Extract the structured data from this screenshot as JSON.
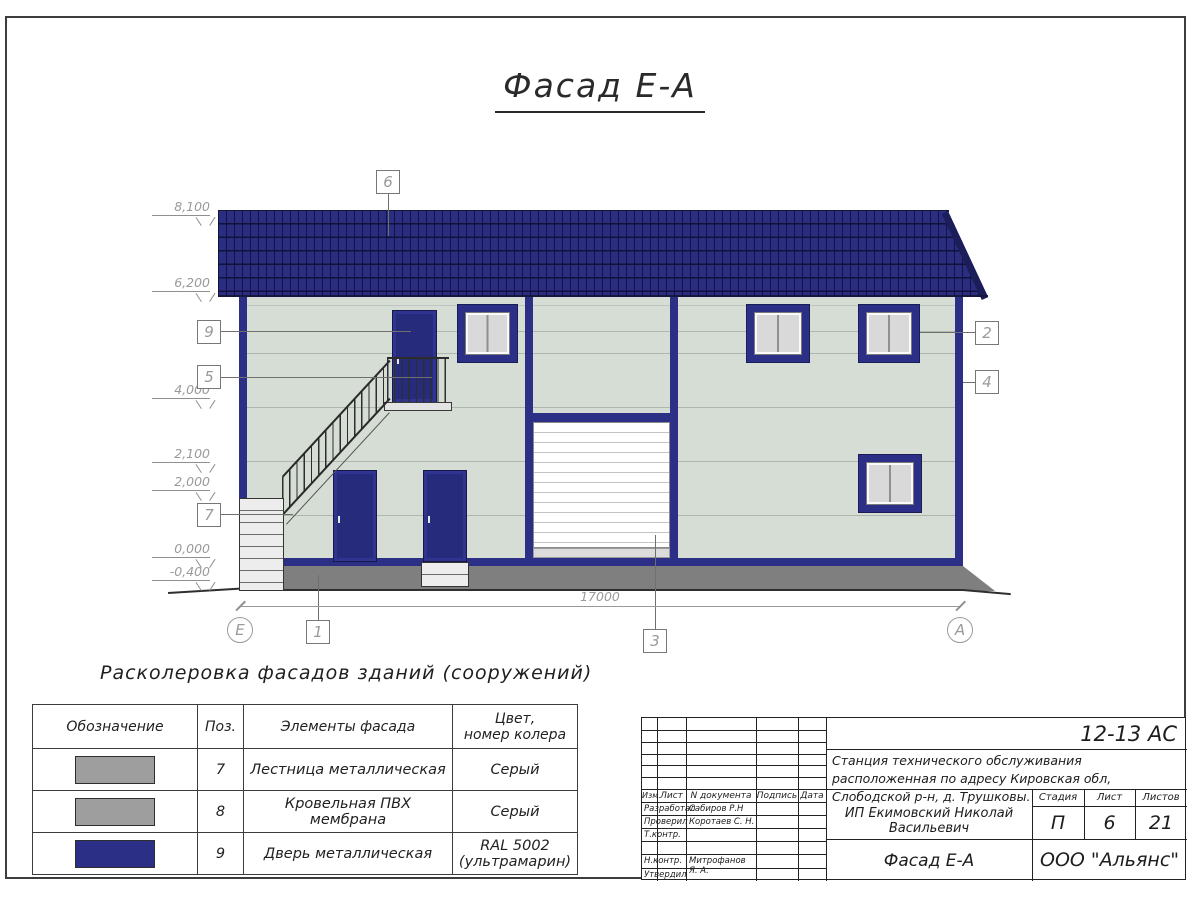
{
  "sheet": {
    "title": "Фасад Е-А"
  },
  "elevation_view": {
    "levels": [
      {
        "value": "8,100"
      },
      {
        "value": "6,200"
      },
      {
        "value": "4,000"
      },
      {
        "value": "2,100"
      },
      {
        "value": "2,000"
      },
      {
        "value": "0,000"
      },
      {
        "value": "-0,400"
      }
    ],
    "callouts": {
      "c1": "1",
      "c2": "2",
      "c3": "3",
      "c4": "4",
      "c5": "5",
      "c6": "6",
      "c7": "7",
      "c9": "9"
    },
    "axes": {
      "left": "Е",
      "right": "А"
    },
    "dimension_total": "17000",
    "colors": {
      "roof": "#2b2e80",
      "wall": "#d6ddd5",
      "trim": "#2b2f86",
      "plinth": "#7f7f7f",
      "door": "#262b7c",
      "glass": "#d9d9d9"
    }
  },
  "legend": {
    "title": "Расколеровка фасадов зданий (сооружений)",
    "headers": [
      "Обозначение",
      "Поз.",
      "Элементы фасада",
      "Цвет,\nномер колера"
    ],
    "rows": [
      {
        "swatch": "#9e9e9e",
        "pos": "7",
        "element": "Лестница металлическая",
        "color": "Серый"
      },
      {
        "swatch": "#9e9e9e",
        "pos": "8",
        "element": "Кровельная ПВХ мембрана",
        "color": "Серый"
      },
      {
        "swatch": "#2b2f86",
        "pos": "9",
        "element": "Дверь металлическая",
        "color": "RAL 5002\n(ультрамарин)"
      }
    ]
  },
  "title_block": {
    "doc_code": "12-13 АС",
    "object_description": "Станция технического обслуживания расположенная по адресу Кировская обл, Слободской р-н, д. Трушковы.",
    "client": "ИП Екимовский Николай Васильевич",
    "columns": {
      "izm": "Изм.",
      "list": "Лист",
      "doc": "N документа",
      "sign": "Подпись",
      "date": "Дата"
    },
    "roles": [
      {
        "role": "Разработал",
        "name": "Сабиров Р.Н"
      },
      {
        "role": "Проверил",
        "name": "Коротаев С. Н."
      },
      {
        "role": "Т.контр.",
        "name": ""
      },
      {
        "role": "",
        "name": ""
      },
      {
        "role": "Н.контр.",
        "name": "Митрофанов Я. А."
      },
      {
        "role": "Утвердил",
        "name": ""
      }
    ],
    "stage_headers": {
      "stage": "Стадия",
      "sheet": "Лист",
      "sheets": "Листов"
    },
    "stage_values": {
      "stage": "П",
      "sheet": "6",
      "sheets": "21"
    },
    "sheet_title": "Фасад Е-А",
    "company": "ООО \"Альянс\""
  }
}
